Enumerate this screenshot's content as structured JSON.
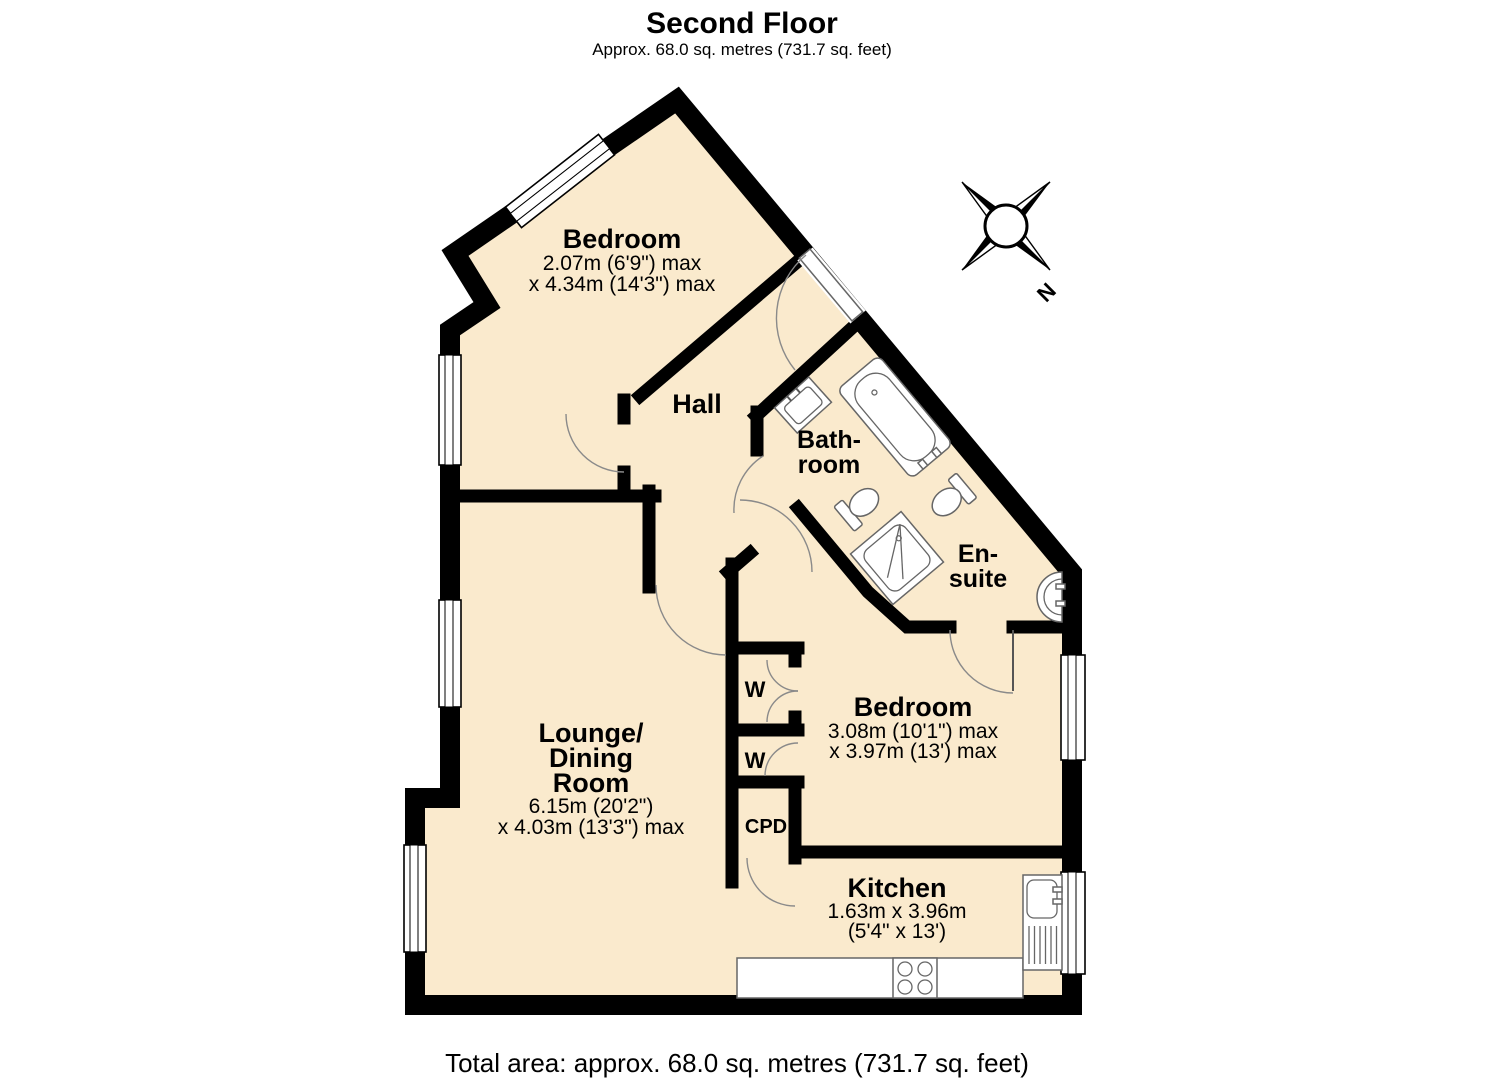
{
  "header": {
    "title": "Second Floor",
    "subtitle": "Approx. 68.0 sq. metres (731.7 sq. feet)"
  },
  "footer": {
    "total_area": "Total area: approx. 68.0 sq. metres (731.7 sq. feet)"
  },
  "compass": {
    "north_label": "N"
  },
  "colors": {
    "floor": "#faeacd",
    "wall": "#000000"
  },
  "rooms": {
    "bedroom_top": {
      "name": "Bedroom",
      "dim1": "2.07m (6'9\") max",
      "dim2": "x 4.34m (14'3\") max"
    },
    "hall": {
      "name": "Hall"
    },
    "bathroom": {
      "line1": "Bath-",
      "line2": "room"
    },
    "ensuite": {
      "line1": "En-",
      "line2": "suite"
    },
    "bedroom_right": {
      "name": "Bedroom",
      "dim1": "3.08m (10'1\") max",
      "dim2": "x 3.97m (13') max"
    },
    "lounge_dining": {
      "line1": "Lounge/",
      "line2": "Dining",
      "line3": "Room",
      "dim1": "6.15m (20'2\")",
      "dim2": "x 4.03m (13'3\") max"
    },
    "kitchen": {
      "name": "Kitchen",
      "dim1": "1.63m x 3.96m",
      "dim2": "(5'4\" x 13')"
    },
    "wardrobe_1": {
      "label": "W"
    },
    "wardrobe_2": {
      "label": "W"
    },
    "cupboard": {
      "label": "CPD"
    }
  }
}
